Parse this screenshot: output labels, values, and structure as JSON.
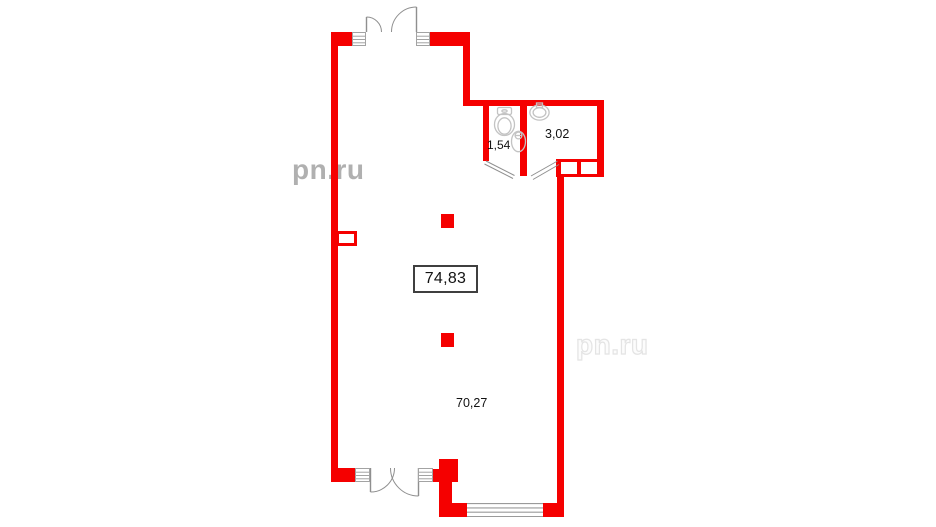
{
  "plan": {
    "area_labels": {
      "total": "74,83",
      "hall": "70,27",
      "wc": "1,54",
      "bathroom": "3,02"
    },
    "watermark": {
      "text": "pn.ru"
    },
    "fixtures": [
      "toilet-icon",
      "washbasin-icon",
      "sink-icon"
    ],
    "colors": {
      "wall": "#f50000",
      "door_line": "#8f8f8f",
      "fixture_line": "#c3c3c3",
      "window_line": "#9a9a9a",
      "label_border": "#3f3f3f",
      "label_text": "#121212",
      "watermark_left": "#b0b0b0",
      "watermark_right": "#e4e4e4"
    }
  }
}
